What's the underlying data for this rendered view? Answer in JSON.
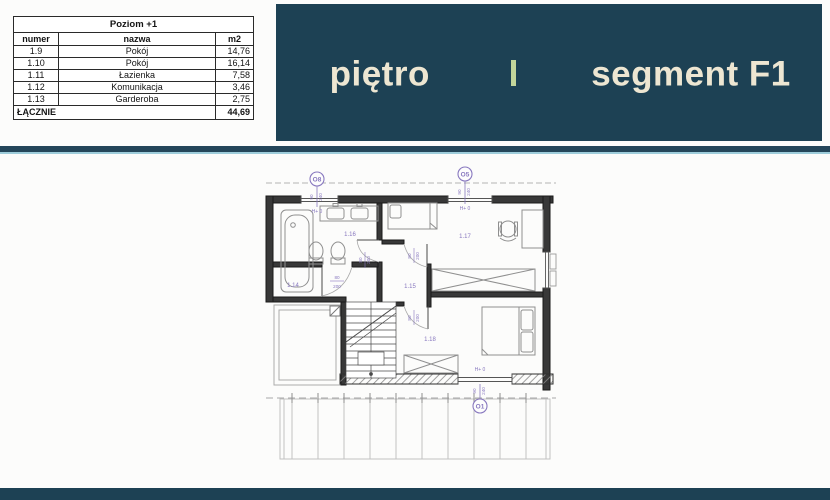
{
  "table": {
    "title": "Poziom +1",
    "columns": {
      "num": "numer",
      "name": "nazwa",
      "area": "m2"
    },
    "rows": [
      {
        "num": "1.9",
        "name": "Pokój",
        "area": "14,76"
      },
      {
        "num": "1.10",
        "name": "Pokój",
        "area": "16,14"
      },
      {
        "num": "1.11",
        "name": "Łazienka",
        "area": "7,58"
      },
      {
        "num": "1.12",
        "name": "Komunikacja",
        "area": "3,46"
      },
      {
        "num": "1.13",
        "name": "Garderoba",
        "area": "2,75"
      }
    ],
    "total_label": "ŁĄCZNIE",
    "total_value": "44,69"
  },
  "banner": {
    "left_text": "piętro",
    "right_text": "segment F1"
  },
  "plan": {
    "window_markers": {
      "o8": "O8",
      "o5": "O5",
      "o1": "O1"
    },
    "room_labels": {
      "r14": "1.14",
      "r15": "1.15",
      "r16": "1.16",
      "r17": "1.17",
      "r18": "1.18"
    },
    "door_size": {
      "width": "80",
      "height": "200"
    },
    "window_size": {
      "width": "90",
      "height": "240"
    },
    "height_label": "H+ 0"
  },
  "colors": {
    "banner_bg": "#1d4154",
    "banner_text": "#ede6d2",
    "separator_accent": "#c3d69b",
    "divider_bar": "#24465a",
    "divider_light_edge": "#9ecddb",
    "plan_annotation": "#8878bf",
    "wall": "#383838"
  }
}
